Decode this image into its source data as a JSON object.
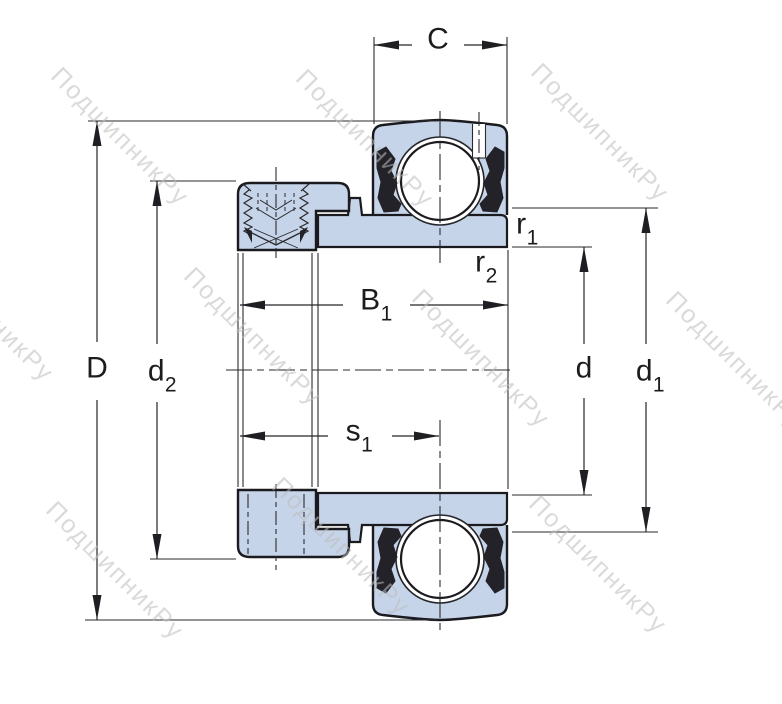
{
  "watermark": {
    "text": "ПодшипникРу"
  },
  "colors": {
    "ring_fill": "#c6d4e9",
    "outline": "#1a1a1f",
    "seal": "#222228",
    "thin_line": "#2a2a2e",
    "label": "#1c1c1e",
    "watermark": "#bdbdbd",
    "background": "#ffffff"
  },
  "labels": {
    "C": {
      "base": "C",
      "sub": ""
    },
    "D": {
      "base": "D",
      "sub": ""
    },
    "d2": {
      "base": "d",
      "sub": "2"
    },
    "B1": {
      "base": "B",
      "sub": "1"
    },
    "s1": {
      "base": "s",
      "sub": "1"
    },
    "r1": {
      "base": "r",
      "sub": "1"
    },
    "r2": {
      "base": "r",
      "sub": "2"
    },
    "d": {
      "base": "d",
      "sub": ""
    },
    "d1": {
      "base": "d",
      "sub": "1"
    }
  }
}
